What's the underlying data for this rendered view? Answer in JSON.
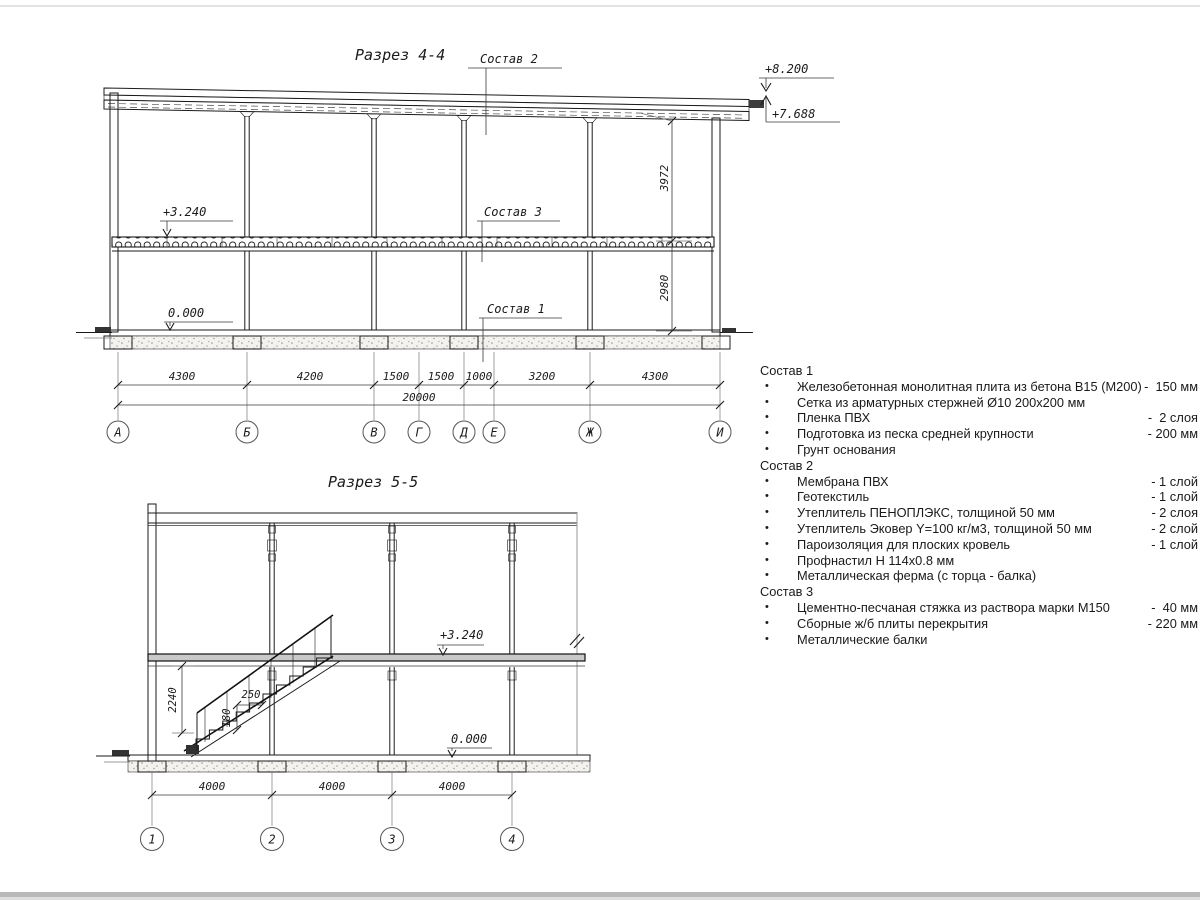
{
  "page": {
    "background": "#ffffff",
    "line_color": "#1b1b1b",
    "dim_color": "#3a3a3a"
  },
  "d44": {
    "title": "Разрез 4-4",
    "lbl_s1": "Состав 1",
    "lbl_s2": "Состав 2",
    "lbl_s3": "Состав 3",
    "e_8200": "+8.200",
    "e_7688": "+7.688",
    "e_3240": "+3.240",
    "e_0": "0.000",
    "v_upper": "3972",
    "v_lower": "2980",
    "dims": [
      "4300",
      "4200",
      "1500",
      "1500",
      "1000",
      "3200",
      "4300"
    ],
    "total": "20000",
    "axes": [
      "А",
      "Б",
      "В",
      "Г",
      "Д",
      "Е",
      "Ж",
      "И"
    ]
  },
  "d55": {
    "title": "Разрез 5-5",
    "e_3240": "+3.240",
    "e_0": "0.000",
    "dim_h": "2240",
    "dim_r": "180",
    "dim_t": "250",
    "dims": [
      "4000",
      "4000",
      "4000"
    ],
    "axes": [
      "1",
      "2",
      "3",
      "4"
    ]
  },
  "mat": {
    "g1": {
      "header": "Состав 1",
      "items": [
        {
          "name": "Железобетонная монолитная плита из бетона В15 (М200)",
          "qty": "-  150 мм"
        },
        {
          "name": "Сетка из арматурных стержней Ø10 200х200 мм",
          "qty": ""
        },
        {
          "name": "Пленка ПВХ",
          "qty": "-  2 слоя"
        },
        {
          "name": "Подготовка из песка средней крупности",
          "qty": "- 200 мм"
        },
        {
          "name": "Грунт основания",
          "qty": ""
        }
      ]
    },
    "g2": {
      "header": "Состав 2",
      "items": [
        {
          "name": "Мембрана ПВХ",
          "qty": "- 1 слой"
        },
        {
          "name": "Геотекстиль",
          "qty": "- 1 слой"
        },
        {
          "name": "Утеплитель ПЕНОПЛЭКС, толщиной 50 мм",
          "qty": "- 2 слоя"
        },
        {
          "name": "Утеплитель Эковер Y=100 кг/м3, толщиной 50 мм",
          "qty": "- 2 слой"
        },
        {
          "name": "Пароизоляция для плоских кровель",
          "qty": "- 1 слой"
        },
        {
          "name": "Профнастил Н 114х0.8 мм",
          "qty": ""
        },
        {
          "name": "Металлическая ферма (с торца - балка)",
          "qty": ""
        }
      ]
    },
    "g3": {
      "header": "Состав 3",
      "items": [
        {
          "name": "Цементно-песчаная стяжка из раствора марки М150",
          "qty": "-  40 мм"
        },
        {
          "name": "Сборные ж/б плиты перекрытия",
          "qty": "- 220 мм"
        },
        {
          "name": "Металлические балки",
          "qty": ""
        }
      ]
    }
  }
}
